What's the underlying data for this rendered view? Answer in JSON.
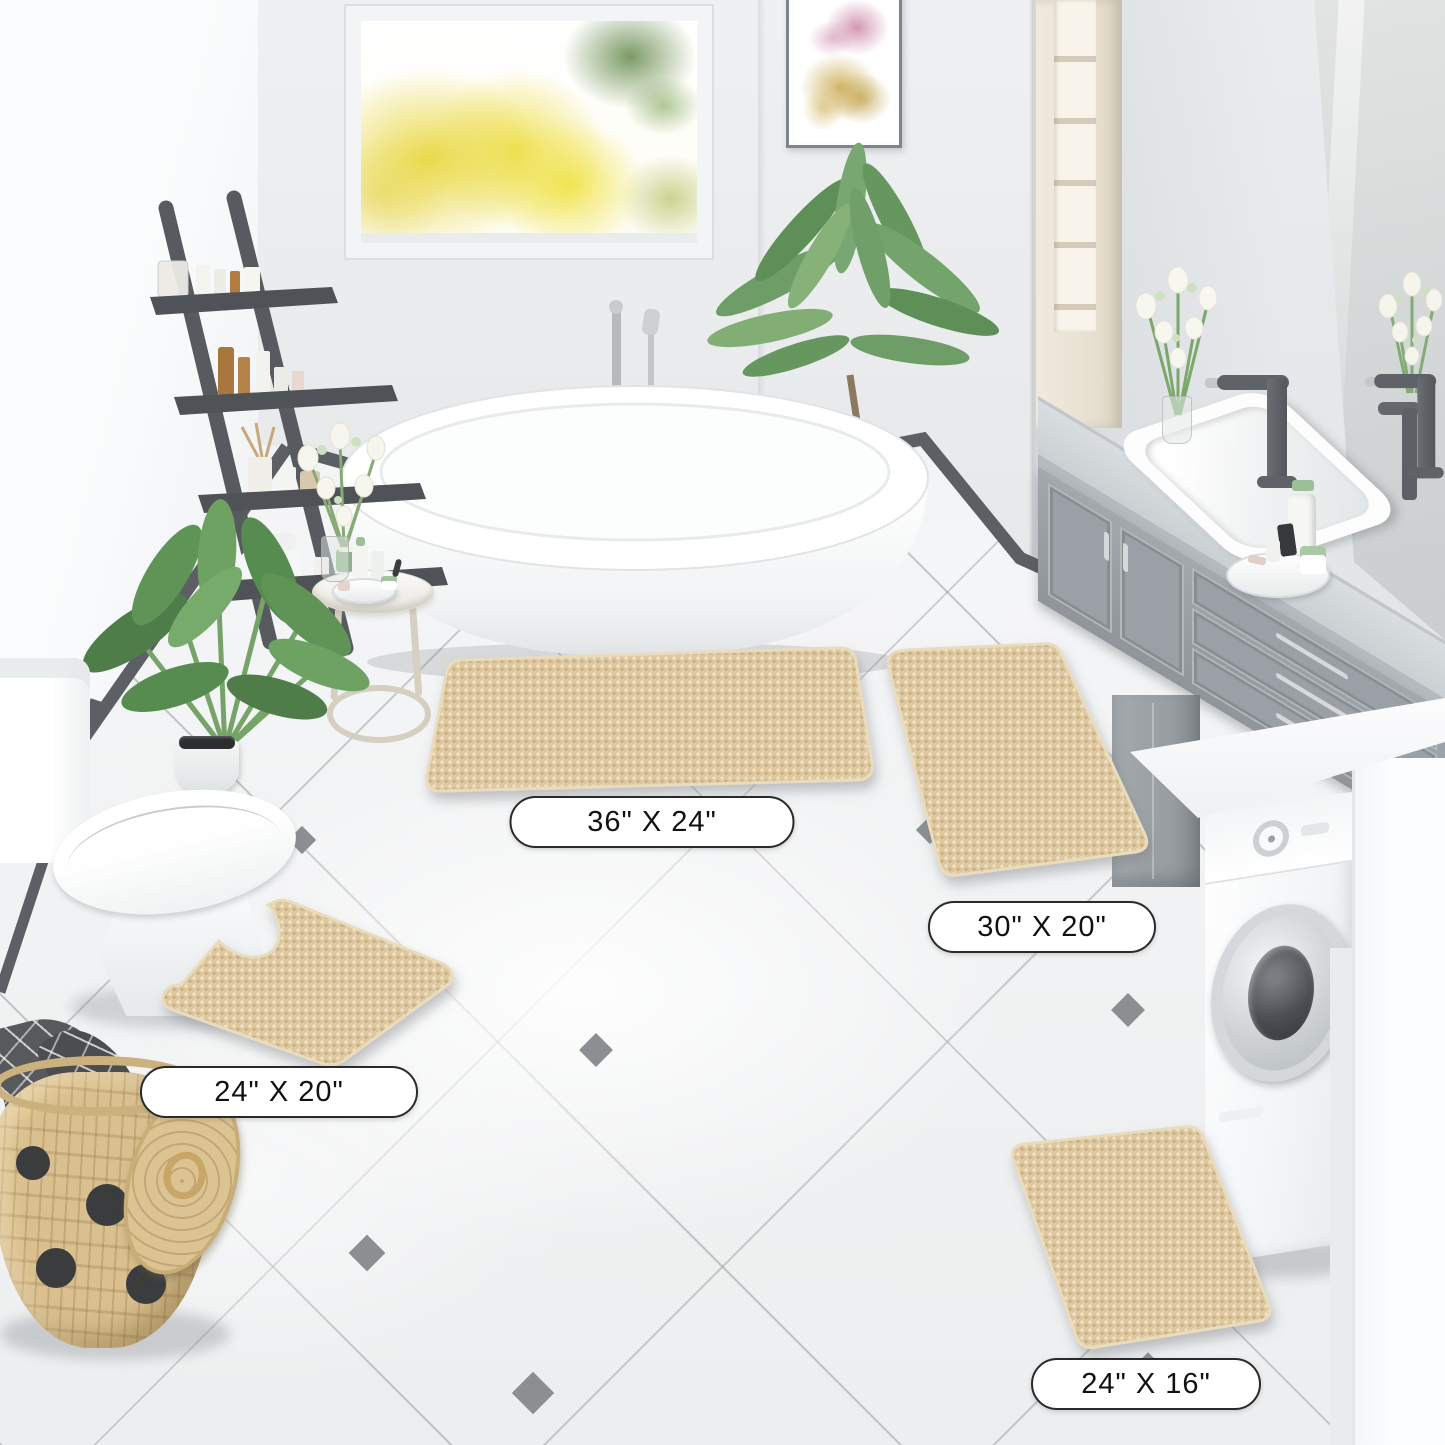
{
  "scene": {
    "labels": {
      "mat_36x24": "36\" X 24\"",
      "mat_30x20": "30\" X 20\"",
      "mat_24x20": "24\" X 20\"",
      "mat_24x16": "24\" X 16\""
    },
    "colors": {
      "mat_beige": "#dfc8a0",
      "mat_edge": "#e9dcbd",
      "mat_shadow_tone": "#c3a577",
      "label_bg": "#ffffff",
      "label_border": "#2a2a2a",
      "label_text": "#111111",
      "wall": "#e8eaec",
      "wall_bright": "#f8f9fa",
      "baseboard": "#5c6064",
      "floor": "#f2f3f4",
      "grout": "#c6c9cb",
      "tile_accent": "#8b8f92",
      "cabinet_gray": "#9ba1a6",
      "counter_gray": "#ced3d6",
      "faucet": "#5f6367",
      "chrome": "#c4c8ca",
      "plant_green": "#5f9456",
      "basket_tan": "#d9c08e",
      "shelf_dark": "#575b5f",
      "cream_cabinet": "#ede7da",
      "window_tree_yellow": "#ecd73a",
      "tub_white": "#ffffff"
    }
  }
}
